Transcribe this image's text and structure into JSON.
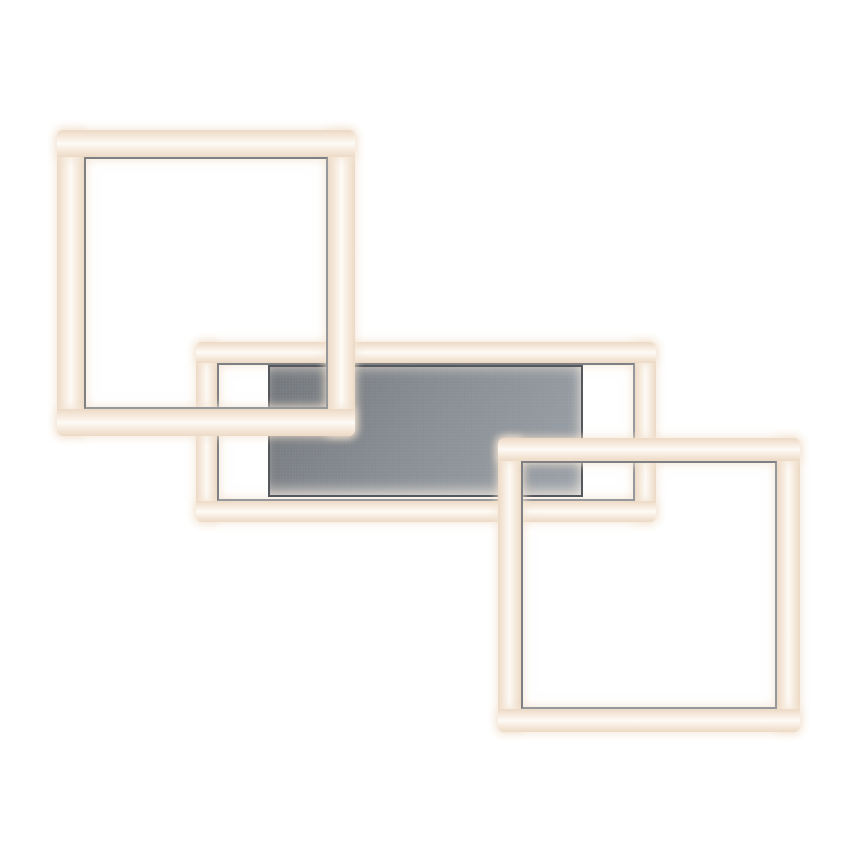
{
  "scene": {
    "description": "Product photo of a modern LED ceiling/wall light: three overlapping rectangular warm-white LED light frames (top-left square, middle horizontal rectangle, bottom-right square) mounted on a grey metal plate, on a pure white background. No text, labels or UI controls are visible.",
    "background": "#ffffff",
    "colors": {
      "background": "#ffffff",
      "led_edge": "#ecd9c5",
      "led_mid": "#f7ecdf",
      "led_core": "#fdfaf6",
      "glow": "rgba(243,228,210,0.85)",
      "metal_line": "#96989b",
      "metal_line_dark": "#7e8083",
      "plate_dark": "#72767b",
      "plate_mid": "#878c92",
      "plate_light": "#9aa1a8",
      "plate_border": "#54575b"
    },
    "frames": [
      {
        "id": "frame-middle",
        "name": "led-frame-middle",
        "x": 196,
        "y": 342,
        "w": 460,
        "h": 180,
        "thickness": 21,
        "z": 1
      },
      {
        "id": "frame-top-left",
        "name": "led-frame-top-left",
        "x": 57,
        "y": 130,
        "w": 298,
        "h": 306,
        "thickness": 27,
        "z": 3
      },
      {
        "id": "frame-bottom-right",
        "name": "led-frame-bottom-right",
        "x": 498,
        "y": 438,
        "w": 302,
        "h": 294,
        "thickness": 23,
        "z": 4
      }
    ],
    "plate": {
      "name": "mounting-plate",
      "x": 268,
      "y": 365,
      "w": 315,
      "h": 132,
      "z": 2
    }
  }
}
